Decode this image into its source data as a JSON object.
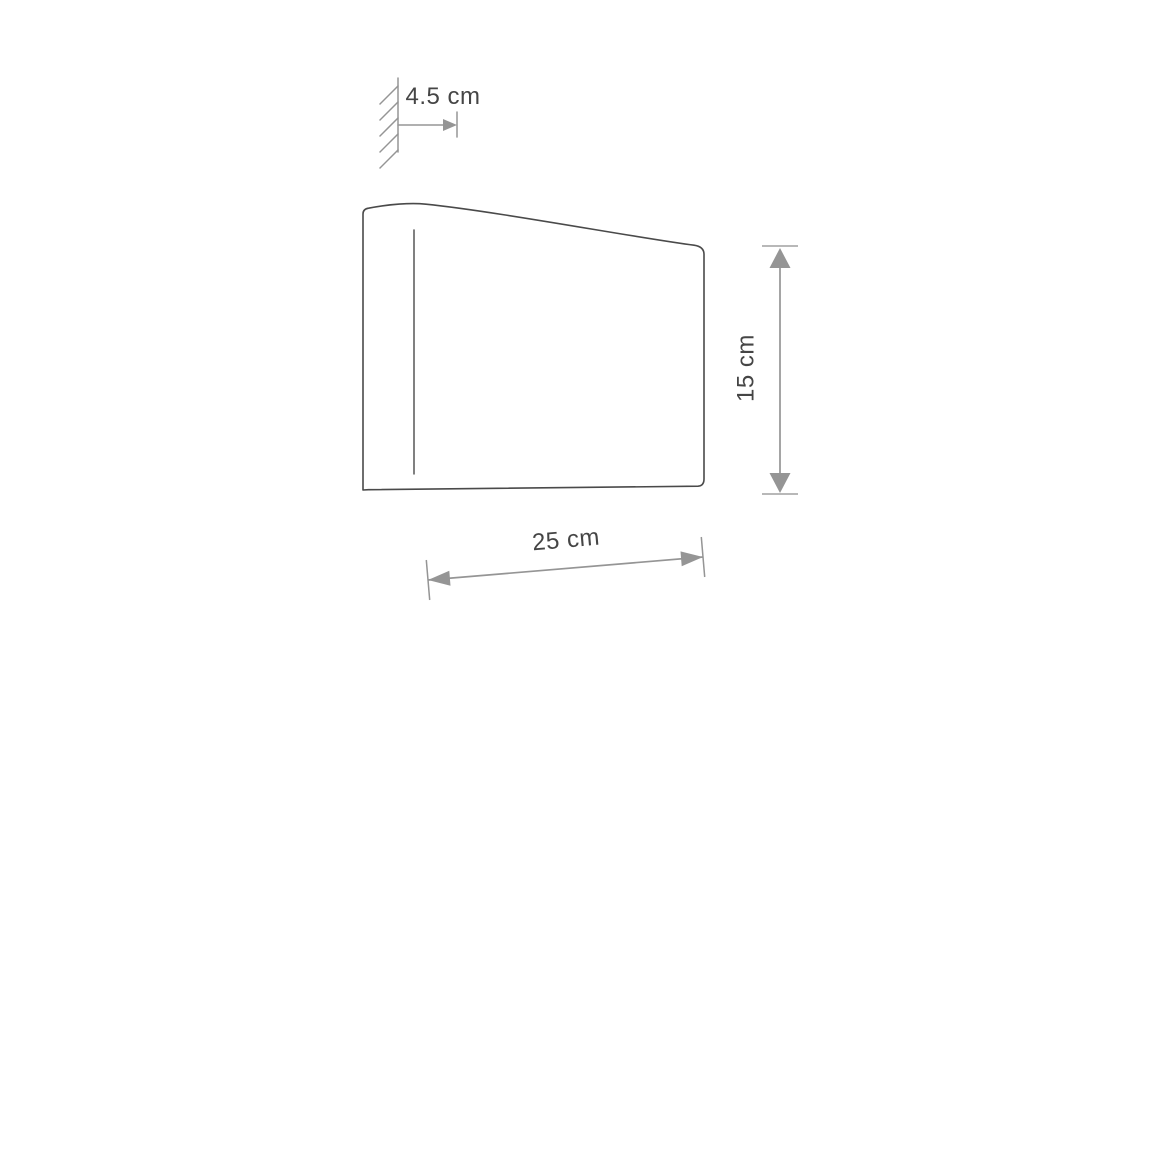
{
  "diagram": {
    "kind": "product dimension drawing",
    "dimensions": [
      {
        "name": "wall-offset-depth",
        "value": "4.5 cm"
      },
      {
        "name": "height",
        "value": "15 cm"
      },
      {
        "name": "width",
        "value": "25 cm"
      }
    ]
  },
  "labels": {
    "wall_offset": "4.5 cm",
    "height": "15 cm",
    "width": "25 cm"
  },
  "colors": {
    "background": "#ffffff",
    "profile_outline": "#4a4a4a",
    "label_text": "#454545",
    "dimension_line": "#959595",
    "extension_cap": "#b8b8b8"
  }
}
